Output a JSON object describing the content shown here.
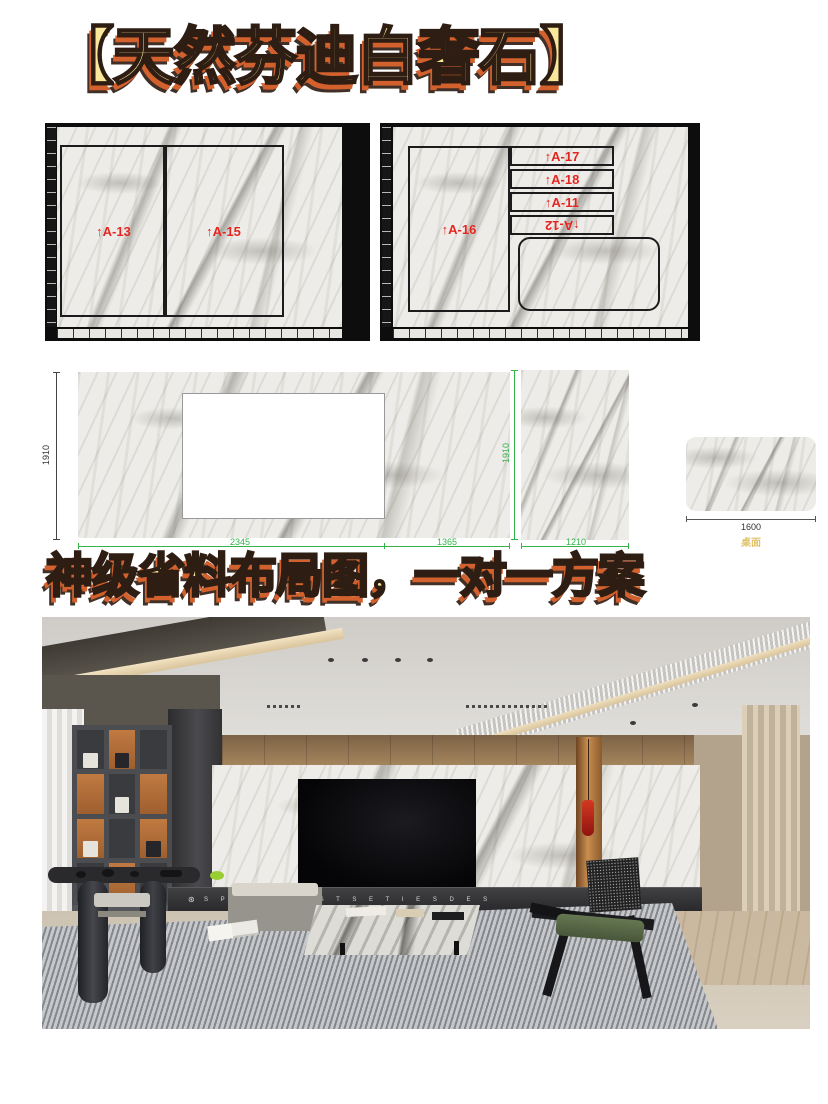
{
  "title": "【天然芬迪白奢石】",
  "subtitle": "神级省料布局图，一对一方案",
  "slab1": {
    "a13": "↑A-13",
    "a15": "↑A-15"
  },
  "slab2": {
    "a16": "↑A-16",
    "a17": "↑A-17",
    "a18": "↑A-18",
    "a11": "↑A-11",
    "a12": "↑A-12"
  },
  "dims": {
    "left_height": "1910",
    "right_height": "1910",
    "w1": "2345",
    "w2": "1365",
    "w3": "1210",
    "table_width": "1600",
    "table_caption": "桌面"
  },
  "photo": {
    "cabinet_logo": "⊛",
    "cabinet_text": "S P A C E   A E S T S E T I E S   D E S"
  },
  "colors": {
    "title_fill": "#f9e79c",
    "title_shadow": "#d2612e",
    "label_red": "#e4251f",
    "dim_green": "#35b34a",
    "caption_yellow": "#e2c36b"
  }
}
